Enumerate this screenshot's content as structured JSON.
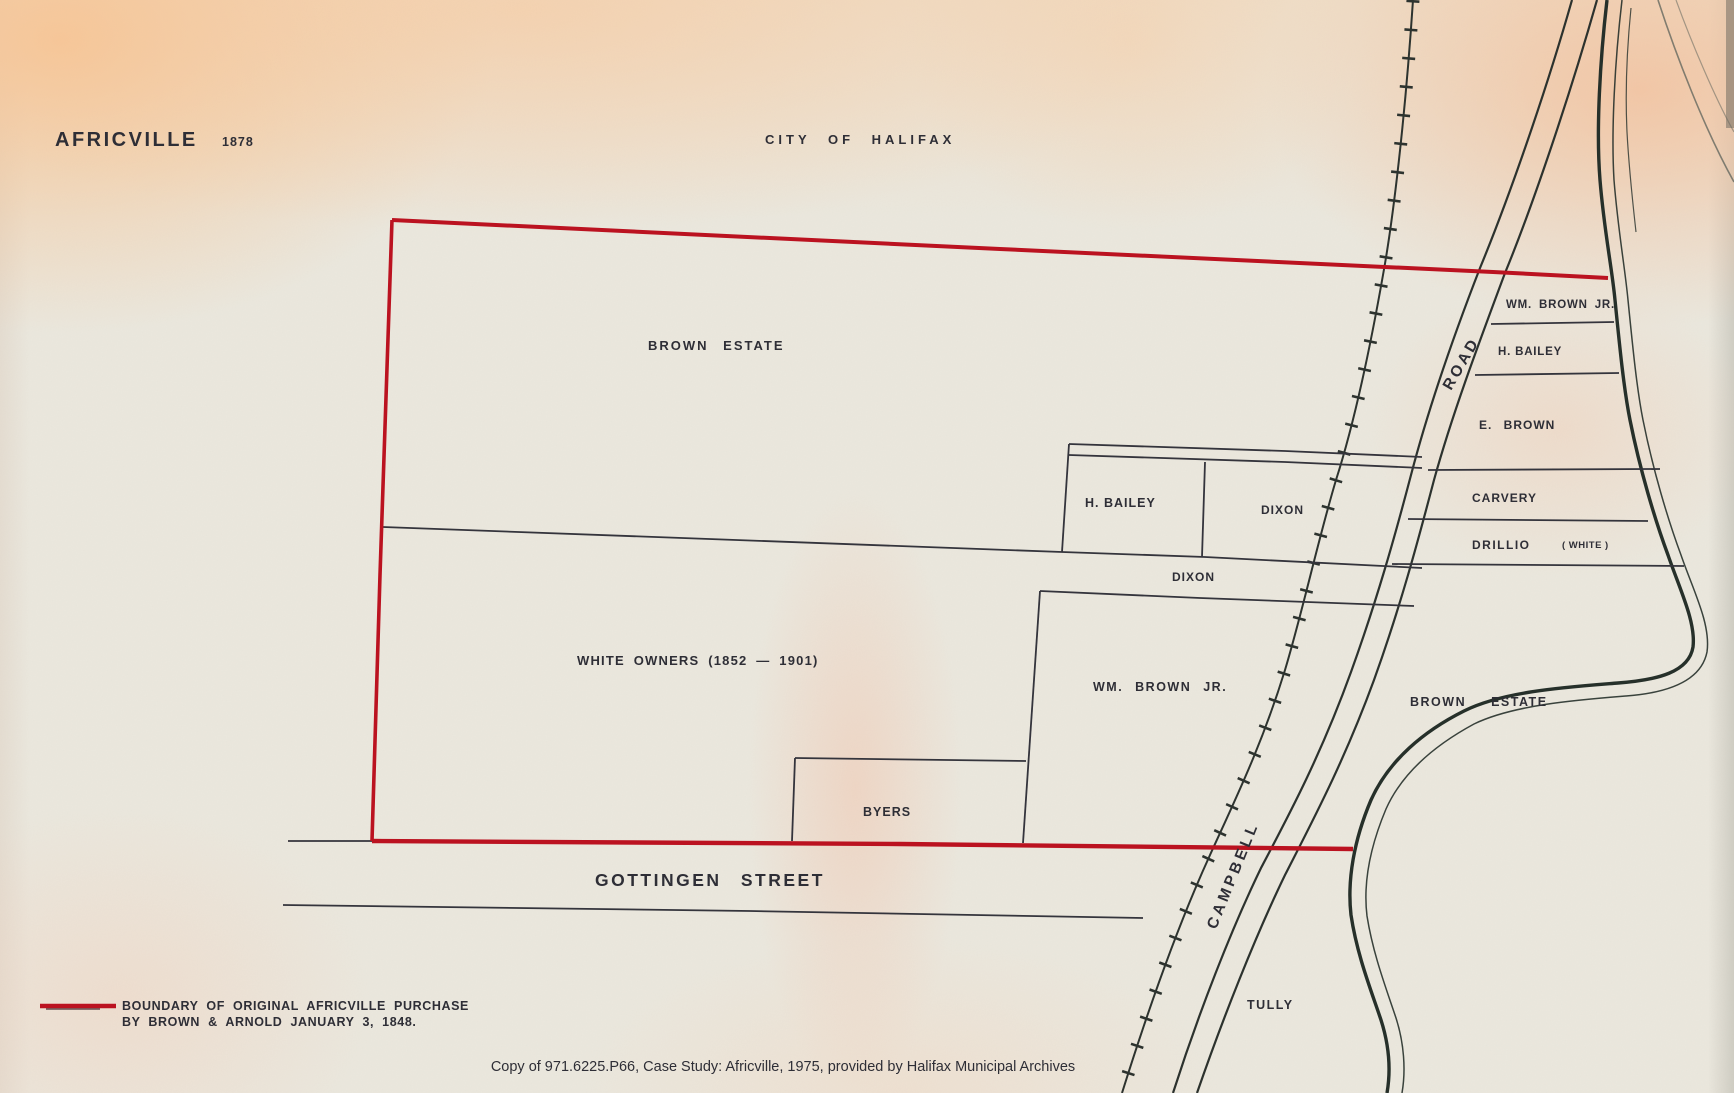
{
  "map": {
    "title": "AFRICVILLE",
    "year": "1878",
    "region_header": "CITY OF HALIFAX",
    "parcels": {
      "brown_estate_west": "BROWN ESTATE",
      "white_owners": "WHITE OWNERS (1852 — 1901)",
      "h_bailey_center": "H. BAILEY",
      "dixon_upper": "DIXON",
      "dixon_strip": "DIXON",
      "wm_brown_jr_center": "WM. BROWN JR.",
      "byers": "BYERS",
      "wm_brown_jr_east": "WM. BROWN JR.",
      "h_bailey_east": "H. BAILEY",
      "e_brown": "E. BROWN",
      "carvery": "CARVERY",
      "drillio": "DRILLIO",
      "drillio_qualifier": "( WHITE )",
      "brown_estate_east": "BROWN ESTATE",
      "tully": "TULLY"
    },
    "streets": {
      "gottingen": "GOTTINGEN  STREET",
      "campbell": "CAMPBELL",
      "road": "ROAD"
    },
    "legend": {
      "line1": "BOUNDARY OF ORIGINAL AFRICVILLE PURCHASE",
      "line2": "BY BROWN & ARNOLD JANUARY 3, 1848."
    },
    "caption": "Copy of 971.6225.P66, Case Study: Africville, 1975, provided by Halifax Municipal Archives",
    "colors": {
      "boundary_red": "#bb1220",
      "ink": "#2c322e",
      "label_ink": "#2e2e36",
      "paper": "#ebe8de"
    }
  }
}
